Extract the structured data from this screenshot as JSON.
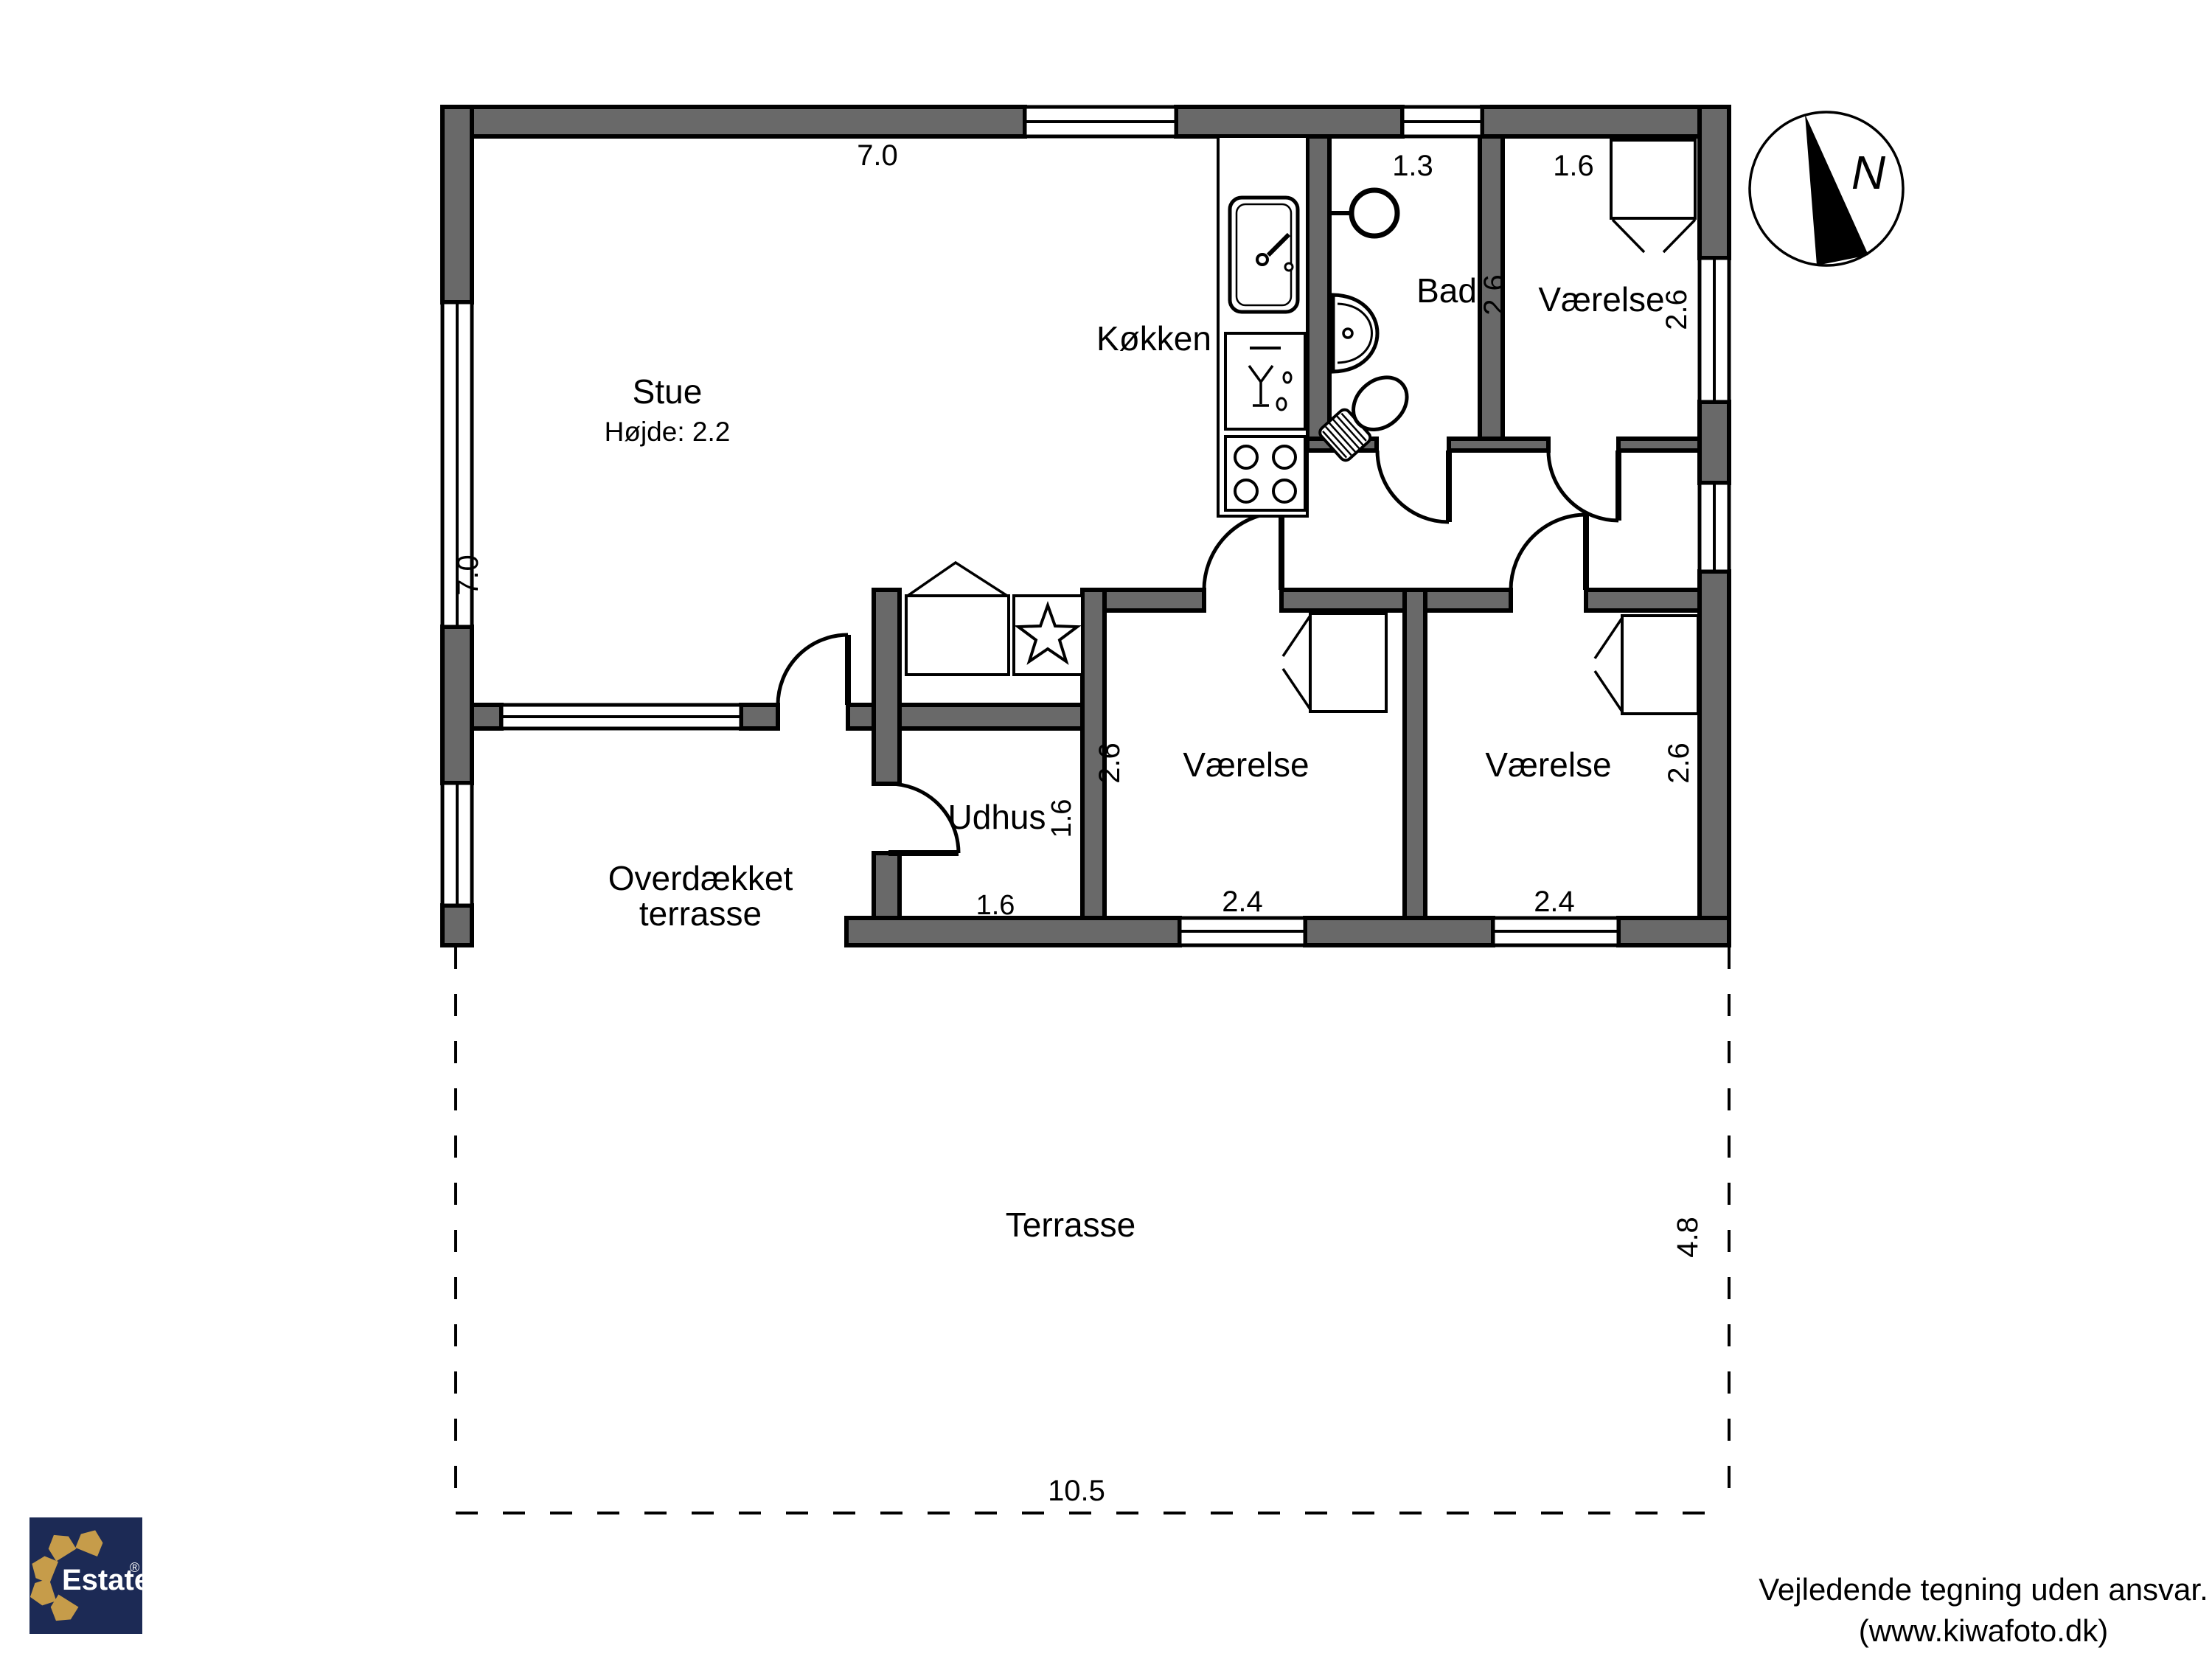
{
  "plan_title": "Floor plan",
  "rooms": {
    "stue": {
      "label": "Stue",
      "height_note": "Højde: 2.2",
      "width": "7.0",
      "depth": "7.0"
    },
    "kokken": {
      "label": "Køkken"
    },
    "bad": {
      "label": "Bad",
      "width": "1.3",
      "depth": "2.6"
    },
    "vaerelse_ne": {
      "label": "Værelse",
      "width": "1.6",
      "depth": "2.6"
    },
    "vaerelse_sw": {
      "label": "Værelse",
      "width": "2.4",
      "depth": "2.6"
    },
    "vaerelse_se": {
      "label": "Værelse",
      "width": "2.4",
      "depth": "2.6"
    },
    "udhus": {
      "label": "Udhus",
      "width": "1.6",
      "depth": "1.6"
    },
    "overdaekket_terrasse": {
      "line1": "Overdækket",
      "line2": "terrasse"
    },
    "terrasse": {
      "label": "Terrasse",
      "width": "10.5",
      "depth": "4.8"
    }
  },
  "compass": {
    "north_letter": "N"
  },
  "branding": {
    "name": "Estate",
    "registered": "®"
  },
  "disclaimer": {
    "line1": "Vejledende tegning uden ansvar.",
    "line2": "(www.kiwafoto.dk)"
  },
  "colors": {
    "wall_gray": "#696969",
    "logo_navy": "#1c2a55",
    "logo_gold": "#c69c4a"
  }
}
